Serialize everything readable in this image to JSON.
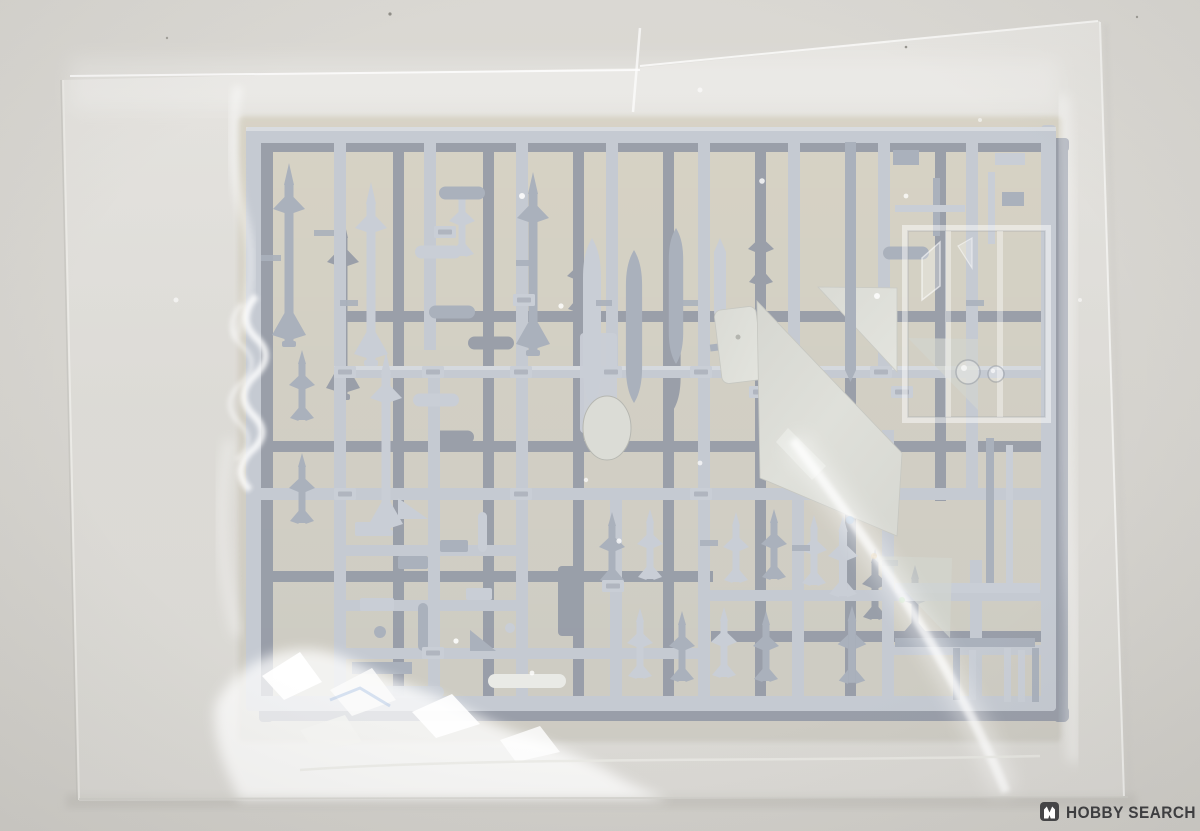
{
  "image": {
    "description": "Product photo: gray plastic model-kit parts sprue (aircraft weapons runner) sealed in a clear plastic bag on a light gray surface"
  },
  "watermark": {
    "icon": "hobby-search-logo-icon",
    "text": "HOBBY SEARCH"
  },
  "colors": {
    "background": "#d6d4cf",
    "bag_film": "#e9e8e5",
    "bag_highlight": "#ffffff",
    "backdrop": "#d4cfc1",
    "sprue_light": "#c5cad2",
    "sprue_mid": "#aab1bc",
    "sprue_dark": "#8e95a4",
    "part_light": "#c9ced6",
    "part_white": "#dbdcd6",
    "shadow": "#bdbbb6",
    "watermark_text": "#3e3e40",
    "watermark_badge": "#454547"
  }
}
